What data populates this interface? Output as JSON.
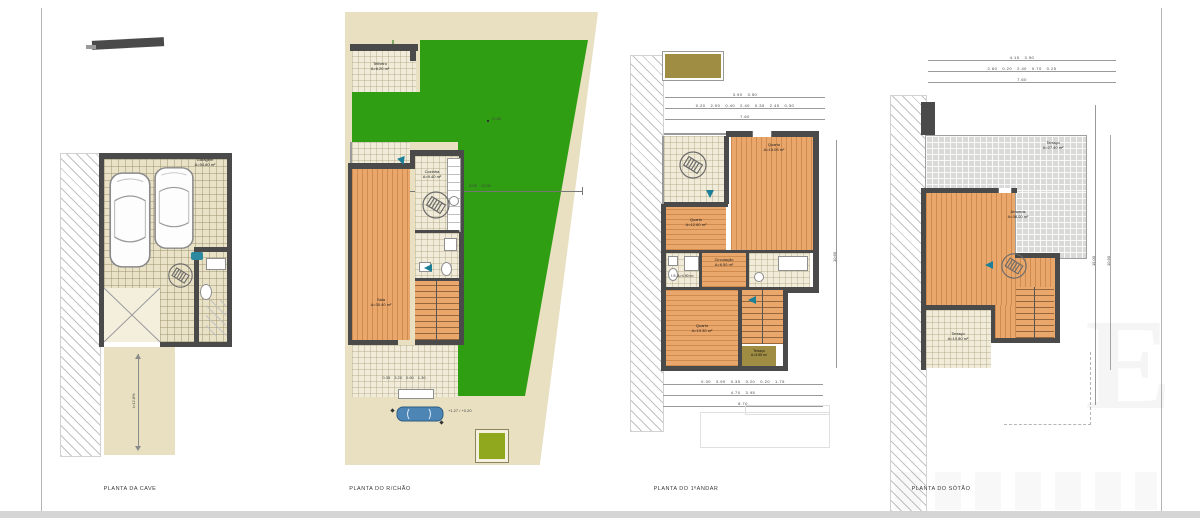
{
  "sheet": {
    "background": "#ffffff",
    "border_color": "#b3b3b3",
    "footer_color": "#d6d6d6"
  },
  "colors": {
    "lawn_green": "#2f9e12",
    "lot_beige": "#e8e0c1",
    "tile_beige": "#e9e2c6",
    "wood_floor": "#eaa76b",
    "wall_gray": "#4a4a4a",
    "accent_teal": "#1c7e97",
    "olive": "#a08d44",
    "bright_olive": "#8fa81e",
    "car_blue": "#4d85b5",
    "terrace_gray": "#d9d9d7"
  },
  "icons": {
    "car_icon": "top-view car outline",
    "car_blue_icon": "small blue car in driveway",
    "spiral_stair_icon": "circle with ladder stair symbol",
    "stair_run_icon": "straight staircase with treads",
    "entry_arrow_icon": "teal entry direction arrow",
    "bath_fixtures_icon": "toilet / sink / tub fixtures"
  },
  "plans": {
    "cave": {
      "title": "PLANTA DA CAVE",
      "garage": {
        "name": "Garagem",
        "area": "A=54.80 m²"
      },
      "ramp_slope": "i=12.8%"
    },
    "rchao": {
      "title": "PLANTA DO R/CHÃO",
      "telheiro": {
        "name": "Telheiro",
        "area": "A=6.20 m²"
      },
      "cozinha": {
        "name": "Cozinha",
        "area": "A=9.40 m²"
      },
      "sala": {
        "name": "Sala",
        "area": "A=30.40 m²"
      },
      "circulacao": {
        "name": "Circulação",
        "area": "A=4.50 m²"
      },
      "garden_dims": [
        "5.05",
        "12.00"
      ],
      "garden_level": "+1.00",
      "entry_level": "+1.27 / +0.20",
      "dims_bottom": [
        "0.35",
        "3.20",
        "0.60",
        "1.30"
      ]
    },
    "andar": {
      "title": "PLANTA DO 1ºANDAR",
      "dims_top_1": [
        "3.90",
        "3.50"
      ],
      "dims_top_2": [
        "0.20",
        "2.90",
        "0.40",
        "2.40",
        "0.35",
        "2.45",
        "0.30"
      ],
      "dims_top_total": "7.60",
      "quarto_1": {
        "name": "Quarto",
        "area": "A=12.60 m²"
      },
      "quarto_2": {
        "name": "Quarto",
        "area": "A=15.05 m²"
      },
      "quarto_3": {
        "name": "Quarto",
        "area": "A=19.30 m²"
      },
      "is": {
        "name": "I.S.",
        "area": "A=4.90 m²"
      },
      "circulacao": {
        "name": "Circulação",
        "area": "A=6.50 m²"
      },
      "terraco": {
        "name": "Terraço",
        "area": "A=3.55 m²"
      },
      "dims_bottom_1": [
        "0.30",
        "3.90",
        "0.35",
        "3.20",
        "0.20",
        "1.75"
      ],
      "dims_bottom_2": [
        "4.70",
        "3.95"
      ],
      "dims_bottom_total": "8.70",
      "dim_right": "10.60"
    },
    "sotao": {
      "title": "PLANTA DO SÓTÃO",
      "dims_top_1": [
        "4.15",
        "3.50"
      ],
      "dims_top_2": [
        "2.60",
        "0.20",
        "2.40",
        "0.70",
        "0.25"
      ],
      "dims_top_total": "7.60",
      "terraco_sup": {
        "name": "Terraço",
        "area": "A=27.40 m²"
      },
      "arrumos": {
        "name": "Arrumos",
        "area": "A=38.00 m²"
      },
      "terraco_inf": {
        "name": "Terraço",
        "area": "A=10.80 m²"
      },
      "dim_right_1": "15.00",
      "dim_right_2": "10.60"
    }
  },
  "watermark": {
    "letter": "E"
  }
}
